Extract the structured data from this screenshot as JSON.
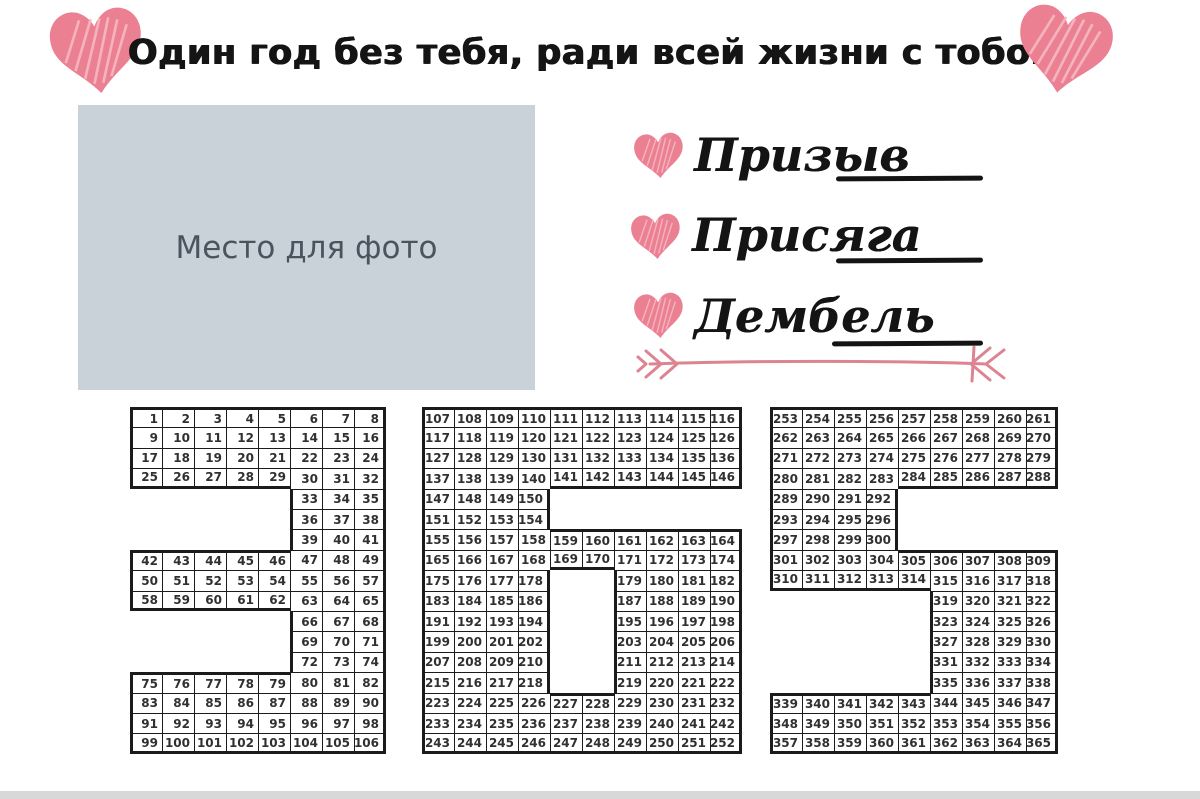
{
  "header": {
    "title": "Один год без тебя, ради всей жизни с тобой!"
  },
  "photo": {
    "label": "Место для фото"
  },
  "fields": [
    {
      "label": "Призыв"
    },
    {
      "label": "Присяга"
    },
    {
      "label": "Дембель"
    }
  ],
  "icons": {
    "heart": "scribble-heart",
    "divider": "double-fletched-arrow"
  },
  "theme": {
    "page_bg": "#ffffff",
    "ink": "#141414",
    "accent_pink": "#ec8093",
    "accent_pink_light": "#f6b9c2",
    "arrow_pink": "#dd8492",
    "photo_bg": "#c9d2d9",
    "photo_text": "#4a545f",
    "grid_ink": "#1b1b1b",
    "cell_text": "#303030",
    "strip": "#d8d8d8"
  },
  "calendar": {
    "total_days": 365,
    "grids": [
      {
        "digit": "3",
        "columns": 8,
        "rows": [
          [
            [
              1,
              [
                1,
                2,
                3,
                4,
                5,
                6,
                7,
                8
              ]
            ]
          ],
          [
            [
              1,
              [
                9,
                10,
                11,
                12,
                13,
                14,
                15,
                16
              ]
            ]
          ],
          [
            [
              1,
              [
                17,
                18,
                19,
                20,
                21,
                22,
                23,
                24
              ]
            ]
          ],
          [
            [
              1,
              [
                25,
                26,
                27,
                28,
                29,
                30,
                31,
                32
              ]
            ]
          ],
          [
            [
              6,
              [
                33,
                34,
                35
              ]
            ]
          ],
          [
            [
              6,
              [
                36,
                37,
                38
              ]
            ]
          ],
          [
            [
              6,
              [
                39,
                40,
                41
              ]
            ]
          ],
          [
            [
              1,
              [
                42,
                43,
                44,
                45,
                46,
                47,
                48,
                49
              ]
            ]
          ],
          [
            [
              1,
              [
                50,
                51,
                52,
                53,
                54,
                55,
                56,
                57
              ]
            ]
          ],
          [
            [
              1,
              [
                58,
                59,
                60,
                61,
                62,
                63,
                64,
                65
              ]
            ]
          ],
          [
            [
              6,
              [
                66,
                67,
                68
              ]
            ]
          ],
          [
            [
              6,
              [
                69,
                70,
                71
              ]
            ]
          ],
          [
            [
              6,
              [
                72,
                73,
                74
              ]
            ]
          ],
          [
            [
              1,
              [
                75,
                76,
                77,
                78,
                79,
                80,
                81,
                82
              ]
            ]
          ],
          [
            [
              1,
              [
                83,
                84,
                85,
                86,
                87,
                88,
                89,
                90
              ]
            ]
          ],
          [
            [
              1,
              [
                91,
                92,
                93,
                94,
                95,
                96,
                97,
                98
              ]
            ]
          ],
          [
            [
              1,
              [
                99,
                100,
                101,
                102,
                103,
                104,
                105,
                106
              ]
            ]
          ]
        ]
      },
      {
        "digit": "6",
        "columns": 10,
        "rows": [
          [
            [
              1,
              [
                107,
                108,
                109,
                110,
                111,
                112,
                113,
                114,
                115,
                116
              ]
            ]
          ],
          [
            [
              1,
              [
                117,
                118,
                119,
                120,
                121,
                122,
                123,
                124,
                125,
                126
              ]
            ]
          ],
          [
            [
              1,
              [
                127,
                128,
                129,
                130,
                131,
                132,
                133,
                134,
                135,
                136
              ]
            ]
          ],
          [
            [
              1,
              [
                137,
                138,
                139,
                140,
                141,
                142,
                143,
                144,
                145,
                146
              ]
            ]
          ],
          [
            [
              1,
              [
                147,
                148,
                149,
                150
              ]
            ]
          ],
          [
            [
              1,
              [
                151,
                152,
                153,
                154
              ]
            ]
          ],
          [
            [
              1,
              [
                155,
                156,
                157,
                158,
                159,
                160,
                161,
                162,
                163,
                164
              ]
            ]
          ],
          [
            [
              1,
              [
                165,
                166,
                167,
                168,
                169,
                170,
                171,
                172,
                173,
                174
              ]
            ]
          ],
          [
            [
              1,
              [
                175,
                176,
                177,
                178
              ]
            ],
            [
              7,
              [
                179,
                180,
                181,
                182
              ]
            ]
          ],
          [
            [
              1,
              [
                183,
                184,
                185,
                186
              ]
            ],
            [
              7,
              [
                187,
                188,
                189,
                190
              ]
            ]
          ],
          [
            [
              1,
              [
                191,
                192,
                193,
                194
              ]
            ],
            [
              7,
              [
                195,
                196,
                197,
                198
              ]
            ]
          ],
          [
            [
              1,
              [
                199,
                200,
                201,
                202
              ]
            ],
            [
              7,
              [
                203,
                204,
                205,
                206
              ]
            ]
          ],
          [
            [
              1,
              [
                207,
                208,
                209,
                210
              ]
            ],
            [
              7,
              [
                211,
                212,
                213,
                214
              ]
            ]
          ],
          [
            [
              1,
              [
                215,
                216,
                217,
                218
              ]
            ],
            [
              7,
              [
                219,
                220,
                221,
                222
              ]
            ]
          ],
          [
            [
              1,
              [
                223,
                224,
                225,
                226,
                227,
                228,
                229,
                230,
                231,
                232
              ]
            ]
          ],
          [
            [
              1,
              [
                233,
                234,
                235,
                236,
                237,
                238,
                239,
                240,
                241,
                242
              ]
            ]
          ],
          [
            [
              1,
              [
                243,
                244,
                245,
                246,
                247,
                248,
                249,
                250,
                251,
                252
              ]
            ]
          ]
        ]
      },
      {
        "digit": "5",
        "columns": 9,
        "rows": [
          [
            [
              1,
              [
                253,
                254,
                255,
                256,
                257,
                258,
                259,
                260,
                261
              ]
            ]
          ],
          [
            [
              1,
              [
                262,
                263,
                264,
                265,
                266,
                267,
                268,
                269,
                270
              ]
            ]
          ],
          [
            [
              1,
              [
                271,
                272,
                273,
                274,
                275,
                276,
                277,
                278,
                279
              ]
            ]
          ],
          [
            [
              1,
              [
                280,
                281,
                282,
                283,
                284,
                285,
                286,
                287,
                288
              ]
            ]
          ],
          [
            [
              1,
              [
                289,
                290,
                291,
                292
              ]
            ]
          ],
          [
            [
              1,
              [
                293,
                294,
                295,
                296
              ]
            ]
          ],
          [
            [
              1,
              [
                297,
                298,
                299,
                300
              ]
            ]
          ],
          [
            [
              1,
              [
                301,
                302,
                303,
                304,
                305,
                306,
                307,
                308,
                309
              ]
            ]
          ],
          [
            [
              1,
              [
                310,
                311,
                312,
                313,
                314,
                315,
                316,
                317,
                318
              ]
            ]
          ],
          [
            [
              6,
              [
                319,
                320,
                321,
                322
              ]
            ]
          ],
          [
            [
              6,
              [
                323,
                324,
                325,
                326
              ]
            ]
          ],
          [
            [
              6,
              [
                327,
                328,
                329,
                330
              ]
            ]
          ],
          [
            [
              6,
              [
                331,
                332,
                333,
                334
              ]
            ]
          ],
          [
            [
              6,
              [
                335,
                336,
                337,
                338
              ]
            ]
          ],
          [
            [
              1,
              [
                339,
                340,
                341,
                342,
                343,
                344,
                345,
                346,
                347
              ]
            ]
          ],
          [
            [
              1,
              [
                348,
                349,
                350,
                351,
                352,
                353,
                354,
                355,
                356
              ]
            ]
          ],
          [
            [
              1,
              [
                357,
                358,
                359,
                360,
                361,
                362,
                363,
                364,
                365
              ]
            ]
          ]
        ]
      }
    ]
  }
}
